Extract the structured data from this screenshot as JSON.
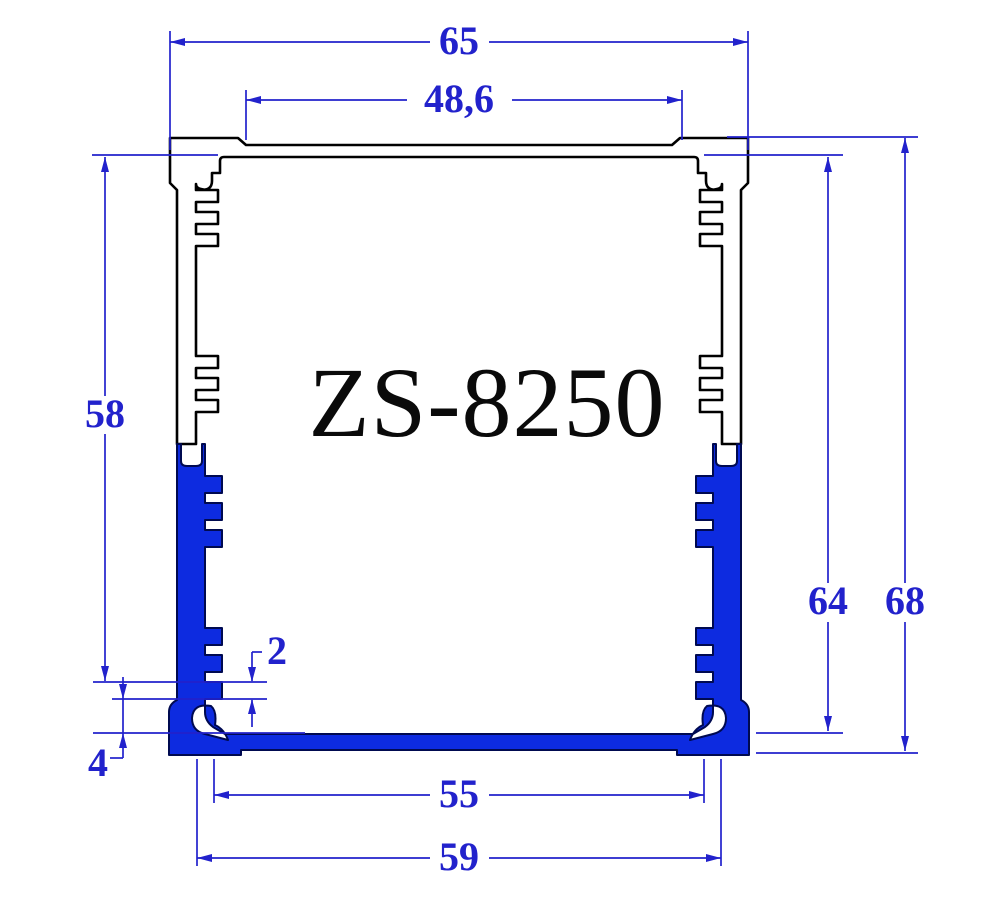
{
  "drawing": {
    "title": "ZS-8250",
    "type": "extrusion-profile-cross-section"
  },
  "dimensions": {
    "top_overall_width": "65",
    "top_inner_width": "48,6",
    "left_wall_height": "58",
    "inner_height": "64",
    "overall_height": "68",
    "tooth_height": "2",
    "tooth_to_floor": "4",
    "bottom_inner_width": "55",
    "bottom_outer_width": "59"
  },
  "colors": {
    "dimension_blue": "#2222cc",
    "tray_fill_blue": "#0d2be0",
    "tray_outline_navy": "#000a50",
    "shell_outline_black": "#000000",
    "background": "#ffffff"
  }
}
